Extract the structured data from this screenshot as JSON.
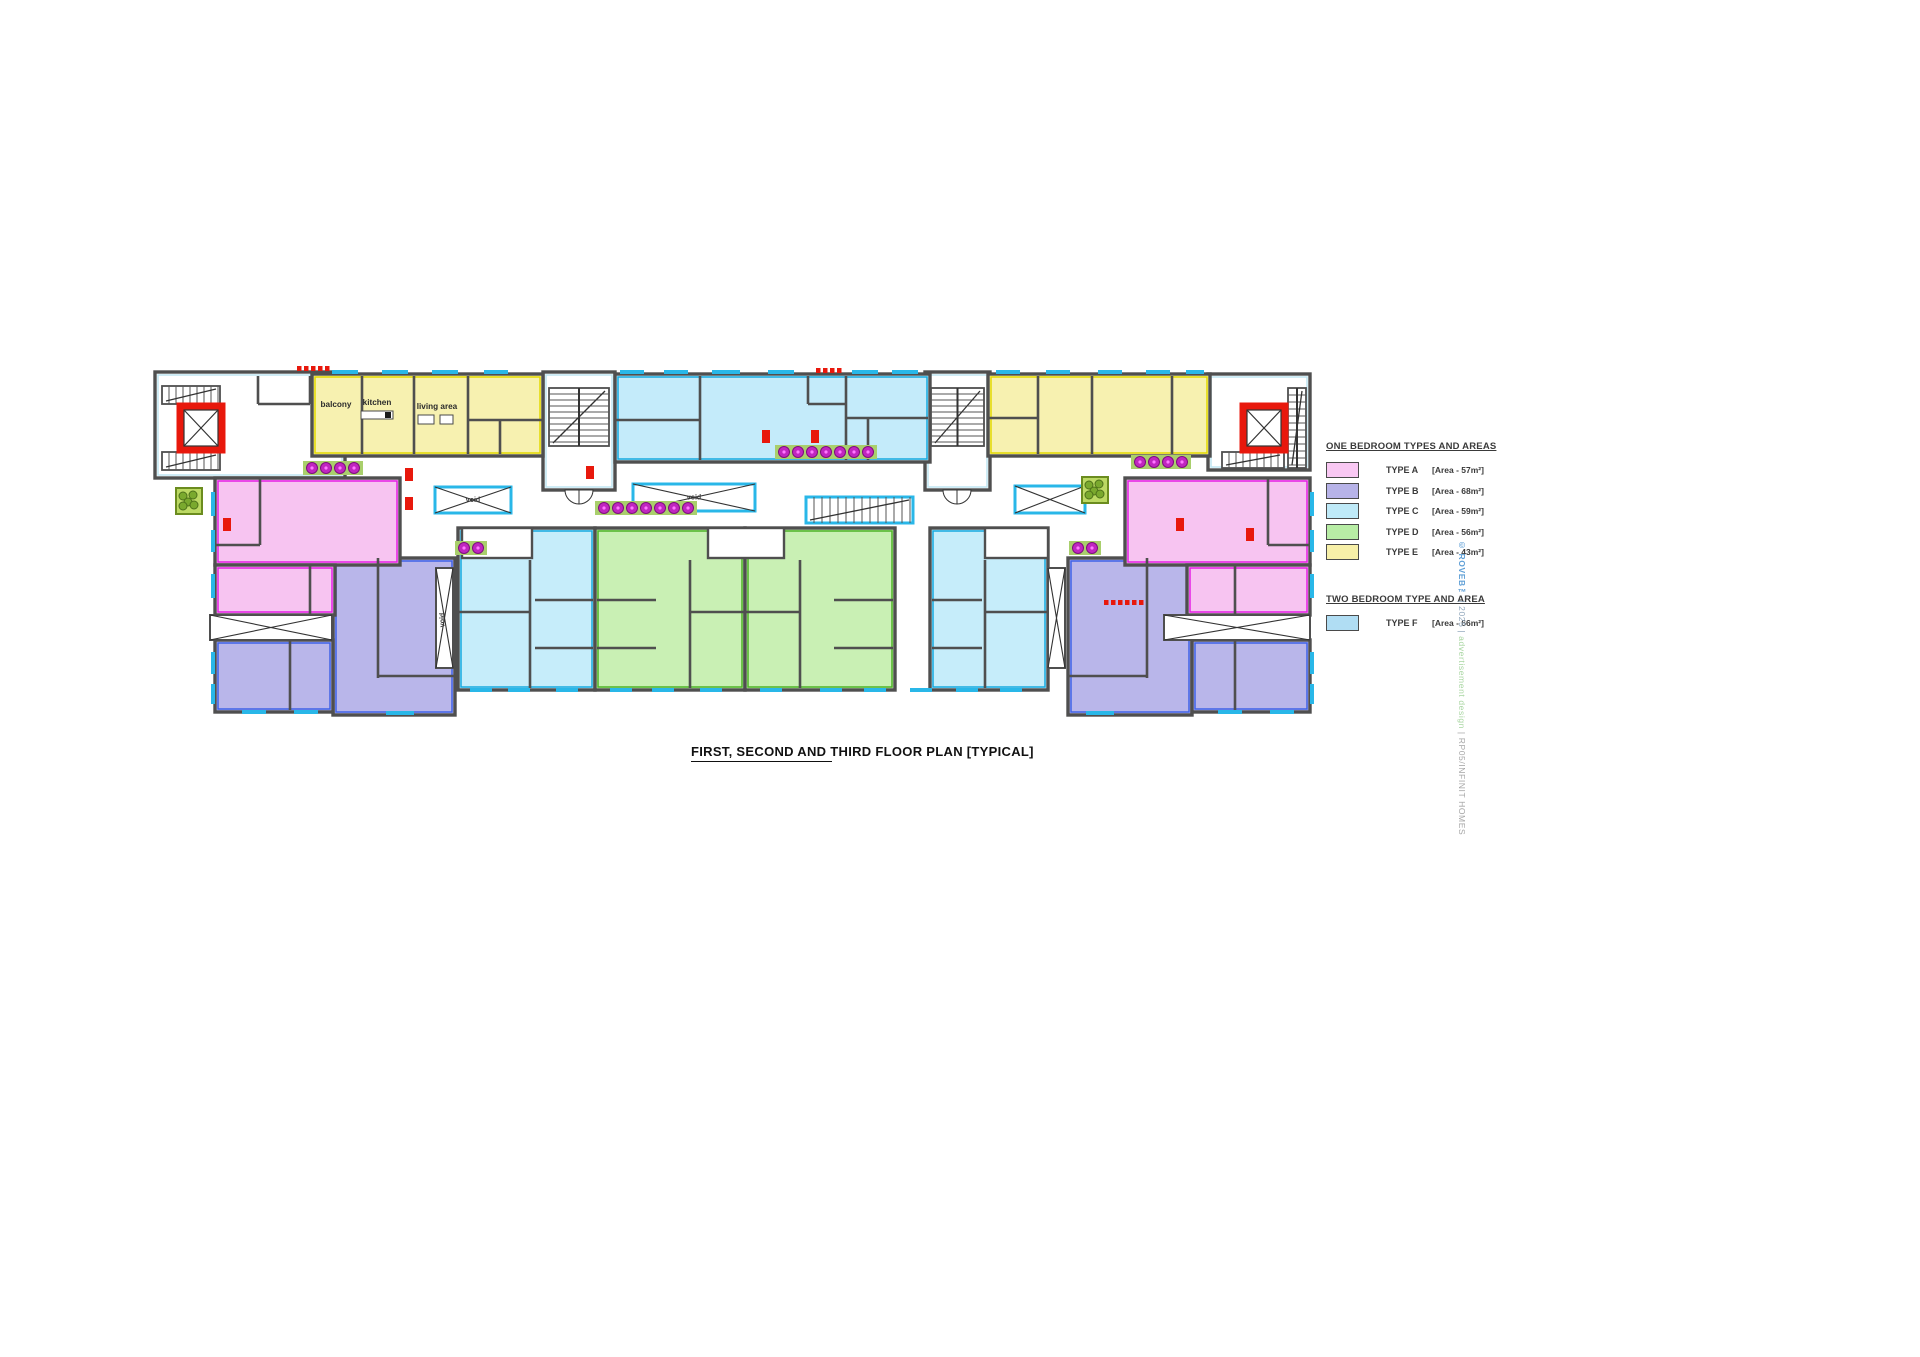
{
  "title": "FIRST, SECOND AND THIRD FLOOR PLAN [TYPICAL]",
  "watermark": {
    "brand": "© ROVEB™",
    "mid": " | 2025 | ",
    "design": "advertisement design",
    "sep": " | ",
    "code": "RP05/INFINIT HOMES"
  },
  "legend": {
    "one_bedroom_title": "ONE BEDROOM TYPES AND AREAS",
    "two_bedroom_title": "TWO BEDROOM TYPE AND AREA",
    "one_bedroom": [
      {
        "label": "TYPE A",
        "area": "[Area - 57m²]",
        "color": "#f9c8f3"
      },
      {
        "label": "TYPE B",
        "area": "[Area - 68m²]",
        "color": "#b7b3e8"
      },
      {
        "label": "TYPE C",
        "area": "[Area - 59m²]",
        "color": "#bfeaf8"
      },
      {
        "label": "TYPE D",
        "area": "[Area - 56m²]",
        "color": "#b8eda5"
      },
      {
        "label": "TYPE E",
        "area": "[Area - 43m²]",
        "color": "#f7f0a8"
      }
    ],
    "two_bedroom": [
      {
        "label": "TYPE F",
        "area": "[Area - 66m²]",
        "color": "#b0ddf3"
      }
    ]
  },
  "colors": {
    "wall": "#4f4f4f",
    "window": "#29b7e8",
    "red": "#e8180c",
    "grass": "#a9cf6c",
    "flower": "#c026c0",
    "A": "#f7c4f1",
    "A_a": "#e51fe5",
    "B": "#b9b6ea",
    "B_a": "#3f62e8",
    "C": "#c6edfa",
    "C_a": "#16aadf",
    "D": "#c9f0b4",
    "D_a": "#4db327",
    "E": "#f7f1b0",
    "E_a": "#e3d900",
    "F": "#c4ebfa",
    "F_a": "#16aadf",
    "L": "#ffffff",
    "L_a": "#bfe6f2"
  },
  "plan": {
    "units": [
      [
        155,
        372,
        190,
        106,
        "L"
      ],
      [
        543,
        372,
        72,
        118,
        "L"
      ],
      [
        925,
        372,
        65,
        118,
        "L"
      ],
      [
        1208,
        374,
        102,
        96,
        "L"
      ],
      [
        312,
        374,
        231,
        82,
        "E"
      ],
      [
        988,
        374,
        222,
        82,
        "E"
      ],
      [
        615,
        374,
        315,
        88,
        "F"
      ],
      [
        333,
        558,
        122,
        157,
        "B"
      ],
      [
        215,
        640,
        118,
        72,
        "B"
      ],
      [
        1068,
        558,
        124,
        157,
        "B"
      ],
      [
        1192,
        640,
        118,
        72,
        "B"
      ],
      [
        215,
        478,
        185,
        87,
        "A"
      ],
      [
        215,
        565,
        120,
        50,
        "A"
      ],
      [
        1125,
        478,
        185,
        87,
        "A"
      ],
      [
        1187,
        565,
        123,
        50,
        "A"
      ],
      [
        458,
        528,
        137,
        162,
        "C"
      ],
      [
        930,
        528,
        118,
        162,
        "C"
      ],
      [
        595,
        528,
        150,
        162,
        "D"
      ],
      [
        745,
        528,
        150,
        162,
        "D"
      ]
    ],
    "notches": [
      [
        462,
        528,
        70,
        30
      ],
      [
        708,
        528,
        76,
        30
      ],
      [
        985,
        528,
        63,
        30
      ]
    ],
    "walls": [
      [
        362,
        376,
        362,
        454
      ],
      [
        414,
        376,
        414,
        454
      ],
      [
        468,
        376,
        468,
        454
      ],
      [
        468,
        420,
        543,
        420
      ],
      [
        500,
        420,
        500,
        454
      ],
      [
        700,
        376,
        700,
        460
      ],
      [
        846,
        376,
        846,
        460
      ],
      [
        808,
        376,
        808,
        404
      ],
      [
        808,
        404,
        846,
        404
      ],
      [
        615,
        420,
        700,
        420
      ],
      [
        846,
        418,
        928,
        418
      ],
      [
        868,
        418,
        868,
        460
      ],
      [
        1038,
        376,
        1038,
        454
      ],
      [
        988,
        418,
        1038,
        418
      ],
      [
        1092,
        376,
        1092,
        454
      ],
      [
        1172,
        376,
        1172,
        454
      ],
      [
        260,
        478,
        260,
        545
      ],
      [
        215,
        545,
        260,
        545
      ],
      [
        310,
        565,
        310,
        614
      ],
      [
        378,
        558,
        378,
        678
      ],
      [
        378,
        676,
        455,
        676
      ],
      [
        290,
        640,
        290,
        710
      ],
      [
        530,
        560,
        530,
        688
      ],
      [
        458,
        612,
        530,
        612
      ],
      [
        535,
        600,
        593,
        600
      ],
      [
        535,
        648,
        593,
        648
      ],
      [
        690,
        560,
        690,
        688
      ],
      [
        690,
        612,
        745,
        612
      ],
      [
        597,
        600,
        656,
        600
      ],
      [
        597,
        648,
        656,
        648
      ],
      [
        800,
        560,
        800,
        688
      ],
      [
        745,
        612,
        800,
        612
      ],
      [
        834,
        600,
        893,
        600
      ],
      [
        834,
        648,
        893,
        648
      ],
      [
        985,
        560,
        985,
        688
      ],
      [
        985,
        612,
        1048,
        612
      ],
      [
        932,
        600,
        982,
        600
      ],
      [
        932,
        648,
        982,
        648
      ],
      [
        1147,
        558,
        1147,
        678
      ],
      [
        1068,
        676,
        1147,
        676
      ],
      [
        1235,
        640,
        1235,
        710
      ],
      [
        1268,
        478,
        1268,
        545
      ],
      [
        1268,
        545,
        1310,
        545
      ],
      [
        1235,
        565,
        1235,
        614
      ],
      [
        258,
        376,
        258,
        404
      ],
      [
        258,
        404,
        310,
        404
      ],
      [
        310,
        376,
        310,
        404
      ]
    ],
    "windows": [
      [
        332,
        372,
        26,
        "h"
      ],
      [
        382,
        372,
        26,
        "h"
      ],
      [
        432,
        372,
        26,
        "h"
      ],
      [
        484,
        372,
        24,
        "h"
      ],
      [
        620,
        372,
        24,
        "h"
      ],
      [
        664,
        372,
        24,
        "h"
      ],
      [
        712,
        372,
        28,
        "h"
      ],
      [
        768,
        372,
        26,
        "h"
      ],
      [
        852,
        372,
        26,
        "h"
      ],
      [
        892,
        372,
        26,
        "h"
      ],
      [
        996,
        372,
        24,
        "h"
      ],
      [
        1046,
        372,
        24,
        "h"
      ],
      [
        1098,
        372,
        24,
        "h"
      ],
      [
        1146,
        372,
        24,
        "h"
      ],
      [
        1186,
        372,
        18,
        "h"
      ],
      [
        213,
        492,
        24,
        "v"
      ],
      [
        213,
        530,
        22,
        "v"
      ],
      [
        213,
        574,
        24,
        "v"
      ],
      [
        213,
        652,
        22,
        "v"
      ],
      [
        213,
        684,
        20,
        "v"
      ],
      [
        1312,
        492,
        24,
        "v"
      ],
      [
        1312,
        530,
        22,
        "v"
      ],
      [
        1312,
        574,
        24,
        "v"
      ],
      [
        1312,
        652,
        22,
        "v"
      ],
      [
        1312,
        684,
        20,
        "v"
      ],
      [
        470,
        690,
        22,
        "h"
      ],
      [
        508,
        690,
        22,
        "h"
      ],
      [
        556,
        690,
        22,
        "h"
      ],
      [
        610,
        690,
        22,
        "h"
      ],
      [
        652,
        690,
        22,
        "h"
      ],
      [
        700,
        690,
        22,
        "h"
      ],
      [
        760,
        690,
        22,
        "h"
      ],
      [
        820,
        690,
        22,
        "h"
      ],
      [
        864,
        690,
        22,
        "h"
      ],
      [
        910,
        690,
        22,
        "h"
      ],
      [
        956,
        690,
        22,
        "h"
      ],
      [
        1000,
        690,
        22,
        "h"
      ],
      [
        242,
        712,
        24,
        "h"
      ],
      [
        294,
        712,
        24,
        "h"
      ],
      [
        386,
        713,
        28,
        "h"
      ],
      [
        1086,
        713,
        28,
        "h"
      ],
      [
        1218,
        712,
        24,
        "h"
      ],
      [
        1270,
        712,
        24,
        "h"
      ]
    ],
    "voids": [
      {
        "x": 435,
        "y": 487,
        "w": 76,
        "h": 26,
        "c": 1,
        "t": "void"
      },
      {
        "x": 633,
        "y": 484,
        "w": 122,
        "h": 27,
        "c": 1,
        "t": "void"
      },
      {
        "x": 1015,
        "y": 486,
        "w": 70,
        "h": 27,
        "c": 1
      },
      {
        "x": 436,
        "y": 568,
        "w": 17,
        "h": 100,
        "c": 0,
        "t": "void",
        "r": -90
      },
      {
        "x": 1048,
        "y": 568,
        "w": 17,
        "h": 100,
        "c": 0
      },
      {
        "x": 210,
        "y": 615,
        "w": 122,
        "h": 25,
        "c": 0
      },
      {
        "x": 1164,
        "y": 615,
        "w": 146,
        "h": 25,
        "c": 0
      }
    ],
    "stairs": [
      {
        "x": 549,
        "y": 388,
        "w": 60,
        "h": 58,
        "o": "v",
        "sp": 6,
        "c": 0
      },
      {
        "x": 931,
        "y": 388,
        "w": 53,
        "h": 58,
        "o": "v",
        "sp": 6,
        "c": 0
      },
      {
        "x": 806,
        "y": 497,
        "w": 107,
        "h": 26,
        "o": "h",
        "sp": 8,
        "c": 1
      },
      {
        "x": 162,
        "y": 386,
        "w": 58,
        "h": 18,
        "o": "h",
        "sp": 7,
        "c": 0
      },
      {
        "x": 162,
        "y": 452,
        "w": 58,
        "h": 18,
        "o": "h",
        "sp": 7,
        "c": 0
      },
      {
        "x": 1288,
        "y": 388,
        "w": 18,
        "h": 80,
        "o": "v",
        "sp": 7,
        "c": 0
      },
      {
        "x": 1222,
        "y": 452,
        "w": 62,
        "h": 16,
        "o": "h",
        "sp": 7,
        "c": 0
      }
    ],
    "lifts": [
      {
        "x": 180,
        "y": 406,
        "w": 42,
        "h": 44
      },
      {
        "x": 1243,
        "y": 406,
        "w": 42,
        "h": 44
      }
    ],
    "planters": [
      [
        176,
        488,
        26
      ],
      [
        1082,
        477,
        26
      ]
    ],
    "flowers": [
      [
        312,
        468,
        4
      ],
      [
        784,
        452,
        7
      ],
      [
        604,
        508,
        7
      ],
      [
        1140,
        462,
        4
      ],
      [
        464,
        548,
        2
      ],
      [
        1078,
        548,
        2
      ]
    ],
    "red_marks": [
      [
        223,
        518
      ],
      [
        405,
        468
      ],
      [
        405,
        497
      ],
      [
        586,
        466
      ],
      [
        762,
        430
      ],
      [
        811,
        430
      ],
      [
        1176,
        518
      ],
      [
        1246,
        528
      ]
    ],
    "red_dashes": [
      [
        297,
        366,
        5
      ],
      [
        816,
        368,
        4
      ],
      [
        1104,
        600,
        6
      ]
    ],
    "doors": [
      [
        579,
        490,
        14
      ],
      [
        957,
        490,
        14
      ]
    ],
    "rooms": [
      [
        "balcony",
        336,
        407
      ],
      [
        "kitchen",
        377,
        405
      ],
      [
        "living area",
        437,
        409
      ],
      [
        "bedroom",
        502,
        400
      ],
      [
        "circulation",
        478,
        435
      ],
      [
        "sanitary",
        515,
        432
      ],
      [
        "bedroom",
        648,
        400
      ],
      [
        "sanitary",
        650,
        432
      ],
      [
        "living area",
        706,
        410
      ],
      [
        "kitchen",
        779,
        405
      ],
      [
        "balcony",
        823,
        390
      ],
      [
        "circulation",
        722,
        436
      ],
      [
        "passage",
        794,
        437
      ],
      [
        "master\nbedroom",
        876,
        396
      ],
      [
        "sanitary",
        896,
        431
      ],
      [
        "bedroom",
        1022,
        400
      ],
      [
        "sanitary",
        1008,
        433
      ],
      [
        "circulation",
        1048,
        435
      ],
      [
        "living area",
        1096,
        401
      ],
      [
        "kitchen",
        1147,
        405
      ],
      [
        "balcony",
        1191,
        397
      ],
      [
        "balcony",
        234,
        526
      ],
      [
        "kitchen",
        275,
        513
      ],
      [
        "living area",
        339,
        511
      ],
      [
        "bedroom",
        251,
        583
      ],
      [
        "sanitary",
        306,
        591
      ],
      [
        "corridor",
        356,
        650,
        -90
      ],
      [
        "living area",
        416,
        600
      ],
      [
        "kitchen",
        413,
        659
      ],
      [
        "balcony",
        400,
        690
      ],
      [
        "bedroom",
        249,
        669
      ],
      [
        "sanitary",
        299,
        657
      ],
      [
        "sanitary",
        486,
        591
      ],
      [
        "bedroom",
        497,
        649
      ],
      [
        "living area",
        566,
        546
      ],
      [
        "kitchen",
        566,
        629
      ],
      [
        "balcony",
        578,
        668
      ],
      [
        "living area",
        625,
        546
      ],
      [
        "kitchen",
        630,
        629
      ],
      [
        "balcony",
        650,
        668
      ],
      [
        "sanitary",
        714,
        589
      ],
      [
        "bedroom",
        706,
        649
      ],
      [
        "living area",
        866,
        546
      ],
      [
        "kitchen",
        861,
        629
      ],
      [
        "balcony",
        841,
        668
      ],
      [
        "sanitary",
        776,
        589
      ],
      [
        "bedroom",
        786,
        649
      ],
      [
        "living area",
        956,
        546
      ],
      [
        "kitchen",
        956,
        629
      ],
      [
        "balcony",
        946,
        668
      ],
      [
        "sanitary",
        1016,
        591
      ],
      [
        "bedroom",
        1008,
        649
      ],
      [
        "corridor",
        1152,
        650,
        -90
      ],
      [
        "living area",
        1090,
        592
      ],
      [
        "kitchen",
        1090,
        645
      ],
      [
        "balcony",
        1102,
        684
      ],
      [
        "bedroom",
        1252,
        671
      ],
      [
        "sanitary",
        1205,
        657
      ],
      [
        "living area",
        1190,
        497
      ],
      [
        "kitchen",
        1230,
        501
      ],
      [
        "balcony",
        1270,
        514
      ],
      [
        "bedroom",
        1254,
        574
      ],
      [
        "sanitary",
        1200,
        583
      ]
    ],
    "labels": [
      [
        "walkway",
        382,
        492,
        8
      ],
      [
        "walkway",
        700,
        473,
        8
      ],
      [
        "walkway",
        872,
        486,
        8
      ],
      [
        "walkway",
        1148,
        490,
        8
      ],
      [
        "circulation area",
        295,
        441,
        7.5
      ],
      [
        "circulation area",
        1174,
        451,
        7.5
      ],
      [
        "entrance terrace",
        500,
        538,
        7
      ],
      [
        "entrance terrace",
        745,
        538,
        7
      ],
      [
        "entrance terrace",
        1016,
        538,
        7
      ],
      [
        "stairs lobby",
        579,
        459,
        7.5
      ],
      [
        "stairs lobby",
        956,
        459,
        7.5
      ],
      [
        "landing",
        579,
        384,
        6
      ],
      [
        "landing",
        951,
        384,
        6
      ],
      [
        "landing",
        858,
        511,
        6
      ],
      [
        "lift and stairs\nlobby",
        263,
        424,
        7
      ],
      [
        "lift and stairs\nlobby",
        1240,
        424,
        7
      ],
      [
        "human lift",
        200,
        430,
        6.5
      ],
      [
        "human lift",
        1263,
        430,
        6.5
      ],
      [
        "storage for cleaning\nequipment",
        284,
        384,
        5.5
      ]
    ]
  }
}
